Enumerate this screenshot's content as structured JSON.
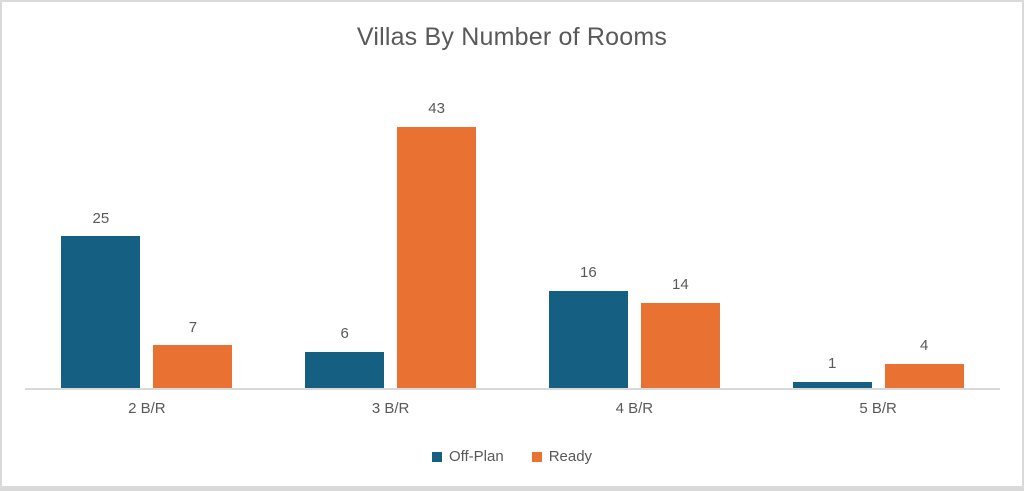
{
  "chart_data": {
    "type": "bar",
    "title": "Villas By Number of Rooms",
    "categories": [
      "2 B/R",
      "3 B/R",
      "4 B/R",
      "5 B/R"
    ],
    "series": [
      {
        "name": "Off-Plan",
        "color": "#156082",
        "values": [
          25,
          6,
          16,
          1
        ]
      },
      {
        "name": "Ready",
        "color": "#E97132",
        "values": [
          7,
          43,
          14,
          4
        ]
      }
    ],
    "data_labels": true,
    "grid": false,
    "ylim": [
      0,
      45
    ],
    "legend_position": "bottom",
    "xlabel": "",
    "ylabel": ""
  },
  "colors": {
    "title_text": "#595959",
    "label_text": "#595959",
    "axis_line": "#D9D9D9",
    "frame": "#D9D9D9",
    "background": "#FFFFFF"
  }
}
